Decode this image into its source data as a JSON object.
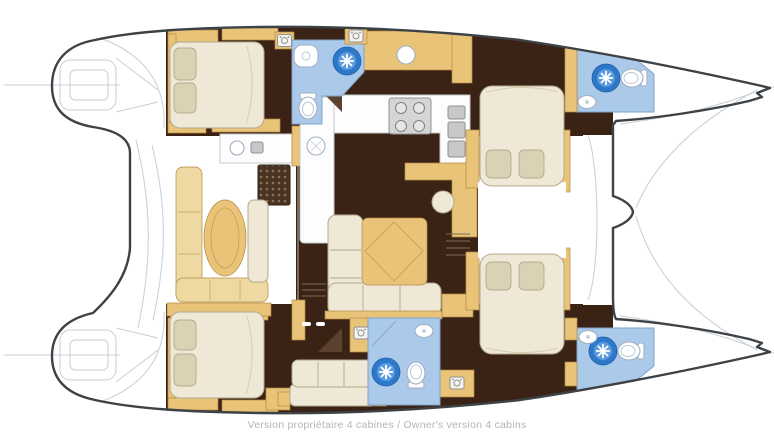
{
  "caption": {
    "text": "Version propriétaire 4 cabines / Owner's version 4 cabins"
  },
  "plan": {
    "type": "catamaran-floor-plan",
    "cabins_shown": 4,
    "bathrooms_shown": 4,
    "icons": [
      "shower-icon",
      "toilet-icon",
      "sink-icon",
      "stove-icon",
      "washer-icon",
      "steps-icon",
      "faucet-icon"
    ],
    "colors": {
      "background": "#ffffff",
      "hull-outline": "#3d4246",
      "faint-line": "#c9ced4",
      "floor-dark": "#3a2315",
      "door-brown": "#5d4130",
      "wood": "#e9c377",
      "wood-stroke": "#b18a45",
      "wood-light": "#eed9a2",
      "cream": "#efe8d6",
      "cream-stroke": "#b3a98e",
      "pillow": "#dbd1b4",
      "pillow-stroke": "#a89d7c",
      "bath-blue": "#abc9e9",
      "bath-stroke": "#7fa3cc",
      "shower-dark": "#2e78ca",
      "shower-mid": "#5b9bde",
      "counter-white": "#fdfdfd",
      "counter-stroke": "#c5c7c9",
      "appliance": "#c6c8ca",
      "appliance-stroke": "#8e9092",
      "caption-text": "#b4b4b6"
    }
  }
}
